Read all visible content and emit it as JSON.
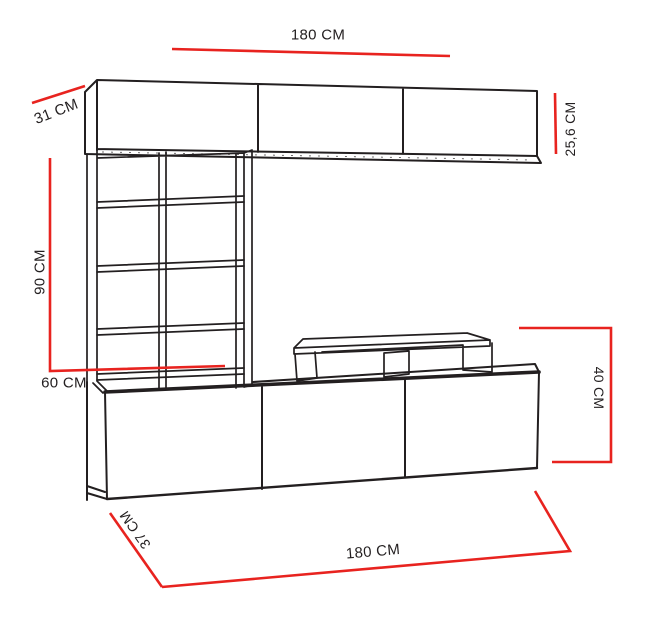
{
  "colors": {
    "outline": "#231f20",
    "dimension_line": "#e8231f",
    "background": "#ffffff"
  },
  "labels": {
    "top_width": "180 CM",
    "top_depth": "31 CM",
    "upper_cabinet_height": "25,6 CM",
    "shelf_column_height": "90 CM",
    "shelf_column_width": "60 CM",
    "base_cabinet_height": "40 CM",
    "base_cabinet_depth": "37 CM",
    "bottom_width": "180 CM"
  }
}
